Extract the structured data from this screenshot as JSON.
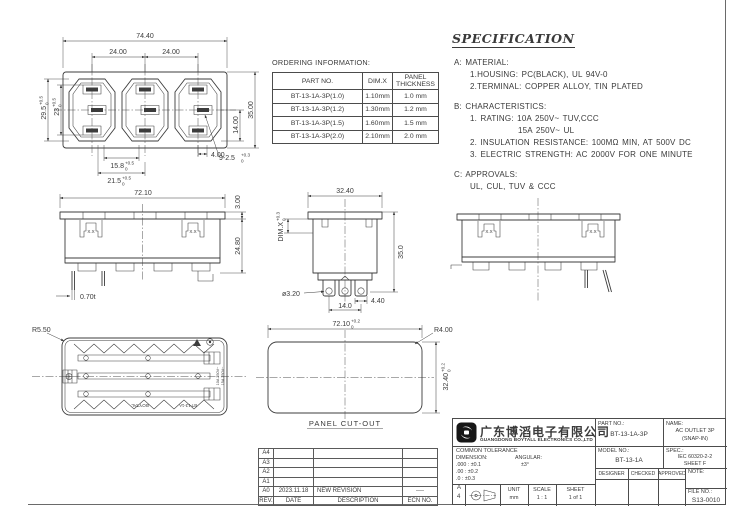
{
  "front": {
    "d_width": "74.40",
    "d_pitch1": "24.00",
    "d_pitch2": "24.00",
    "d_h1": {
      "v": "29.5",
      "p": "+0.5",
      "m": "0"
    },
    "d_h2": {
      "v": "23",
      "p": "+0.5",
      "m": "0"
    },
    "d_r1": "14.00",
    "d_r2": "35.00",
    "d_b1": {
      "v": "15.8",
      "p": "+0.5",
      "m": "0"
    },
    "d_b2": {
      "v": "21.5",
      "p": "+0.5",
      "m": "0"
    },
    "d_b3": "4.00",
    "d_holes": {
      "v": "9-2.5",
      "p": "+0.3",
      "m": "0"
    }
  },
  "ordering": {
    "title": "ORDERING INFORMATION:",
    "headers": [
      "PART NO.",
      "DIM.X",
      "PANEL",
      "THICKNESS"
    ],
    "rows": [
      [
        "BT-13-1A-3P(1.0)",
        "1.10mm",
        "1.0 mm"
      ],
      [
        "BT-13-1A-3P(1.2)",
        "1.30mm",
        "1.2 mm"
      ],
      [
        "BT-13-1A-3P(1.5)",
        "1.60mm",
        "1.5 mm"
      ],
      [
        "BT-13-1A-3P(2.0)",
        "2.10mm",
        "2.0 mm"
      ]
    ]
  },
  "spec": {
    "title": "SPECIFICATION",
    "lines": [
      "A: MATERIAL:",
      "1.HOUSING: PC(BLACK), UL 94V-0",
      "2.TERMINAL: COPPER ALLOY, TIN PLATED",
      "B: CHARACTERISTICS:",
      "1. RATING: 10A 250V~ TUV,CCC",
      "15A 250V~ UL",
      "2. INSULATION RESISTANCE: 100MΩ MIN, AT 500V DC",
      "3. ELECTRIC STRENGTH: AC 2000V FOR ONE MINUTE",
      "C: APPROVALS:",
      "UL, CUL, TUV & CCC"
    ]
  },
  "side": {
    "d_width": "72.10",
    "d_flange": "3.00",
    "d_height": "24.80",
    "d_pin": "0.70t",
    "clip": "X.X"
  },
  "end": {
    "d_width": "32.40",
    "d_dimx": {
      "v": "DIM.X",
      "p": "+0.3",
      "m": "0"
    },
    "d_height": "35.0",
    "d_hole": "ø3.20",
    "d_pitch": "14.0",
    "d_pin": "4.40"
  },
  "rear": {
    "d_radius": "R5.50",
    "markings": {
      "brand": "BOYTAL",
      "model": "BT-13-1A",
      "rating1": "10A 250V~",
      "rating2": "15A 250V~"
    }
  },
  "cutout": {
    "d_width": {
      "v": "72.10",
      "p": "+0.2",
      "m": "0"
    },
    "d_radius": "R4.00",
    "d_height": {
      "v": "32.40",
      "p": "+0.2",
      "m": "0"
    },
    "label": "PANEL CUT-OUT"
  },
  "revision": {
    "rows": [
      [
        "A4",
        "",
        "",
        ""
      ],
      [
        "A3",
        "",
        "",
        ""
      ],
      [
        "A2",
        "",
        "",
        ""
      ],
      [
        "A1",
        "",
        "",
        ""
      ],
      [
        "A0",
        "2023.11.18",
        "NEW REVISION",
        "----"
      ]
    ],
    "footer": [
      "REV.",
      "DATE",
      "DESCRIPTION",
      "ECN NO."
    ]
  },
  "title_block": {
    "company_cn": "广东博滔电子有限公司",
    "company_en": "GUANGDONG BOYTALL ELECTRONICS CO.,LTD",
    "part_no_label": "PART NO.:",
    "part_no": "BT-13-1A-3P",
    "name_label": "NAME:",
    "name_line1": "AC OUTLET 3P",
    "name_line2": "(SNAP-IN)",
    "model_no_label": "MODEL NO.:",
    "model_no": "BT-13-1A",
    "spec_label": "SPEC.:",
    "spec_line1": "IEC 60320-2-2",
    "spec_line2": "SHEET F",
    "designer": "DESIGNER",
    "checked": "CHECKED",
    "approved": "APPROVED",
    "note_label": "NOTE:",
    "tol_title": "COMMON TOLERANCE",
    "tol_dim_label": "DIMENSION:",
    "tol_ang_label": "ANGULAR:",
    "tol_r1": ".000 : ±0.1",
    "tol_r2": ".00  : ±0.2",
    "tol_r3": ".0   : ±0.3",
    "tol_ang": "±3°",
    "size_a": "A",
    "size_4": "4",
    "unit_label": "UNIT",
    "unit": "mm",
    "scale_label": "SCALE",
    "scale": "1 : 1",
    "sheet_label": "SHEET",
    "sheet": "1 of 1",
    "file_label": "FILE NO.:",
    "file_no": "S13-0010"
  }
}
